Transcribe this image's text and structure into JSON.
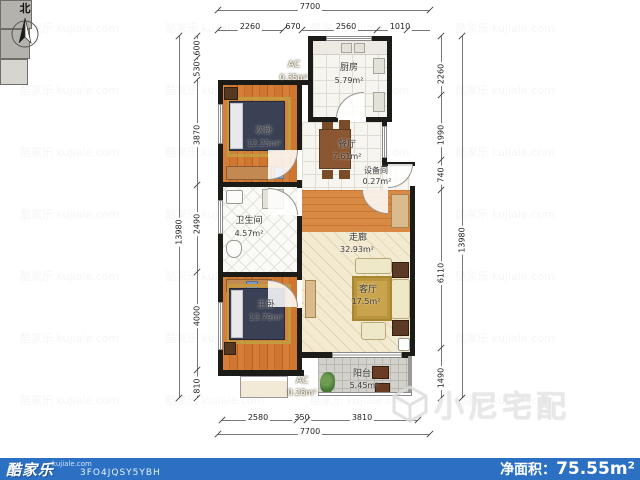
{
  "compass": {
    "north": "北"
  },
  "watermark": {
    "tile_text": "酷家乐 kujiale.com",
    "brand_text": "小尼宅配"
  },
  "rooms": {
    "kitchen": {
      "name": "厨房",
      "area": "5.79m²"
    },
    "bedroom2": {
      "name": "次卧",
      "area": "12.25m²"
    },
    "dining": {
      "name": "餐厅",
      "area": "7.61m²"
    },
    "equipment": {
      "name": "设备间",
      "area": "0.27m²"
    },
    "bathroom": {
      "name": "卫生间",
      "area": "4.57m²"
    },
    "corridor": {
      "name": "走廊",
      "area": "32.93m²"
    },
    "living": {
      "name": "客厅",
      "area": "17.5m²"
    },
    "bedroom1": {
      "name": "主卧",
      "area": "13.79m²"
    },
    "balcony": {
      "name": "阳台",
      "area": "5.45m²"
    },
    "ac_top": {
      "name": "AC",
      "area": "0.35m²"
    },
    "ac_bottom": {
      "name": "AC",
      "area": "0.28m²"
    }
  },
  "dims": {
    "top_total": "7700",
    "top_segments": [
      "2260",
      "670",
      "2560",
      "1010"
    ],
    "bottom_segments": [
      "2580",
      "350",
      "3810"
    ],
    "bottom_total": "7700",
    "left_total": "13980",
    "left_segments": [
      "600",
      "530",
      "3870",
      "2490",
      "4000",
      "810"
    ],
    "right_segments": [
      "2260",
      "1990",
      "740",
      "6110",
      "1490"
    ],
    "right_total": "13980"
  },
  "footer": {
    "brand": "酷家乐",
    "brand_domain": "kujiale.com",
    "plan_id": "3FO4JQSY5YBH",
    "net_area_label": "净面积：",
    "net_area_value": "75.55m²"
  }
}
